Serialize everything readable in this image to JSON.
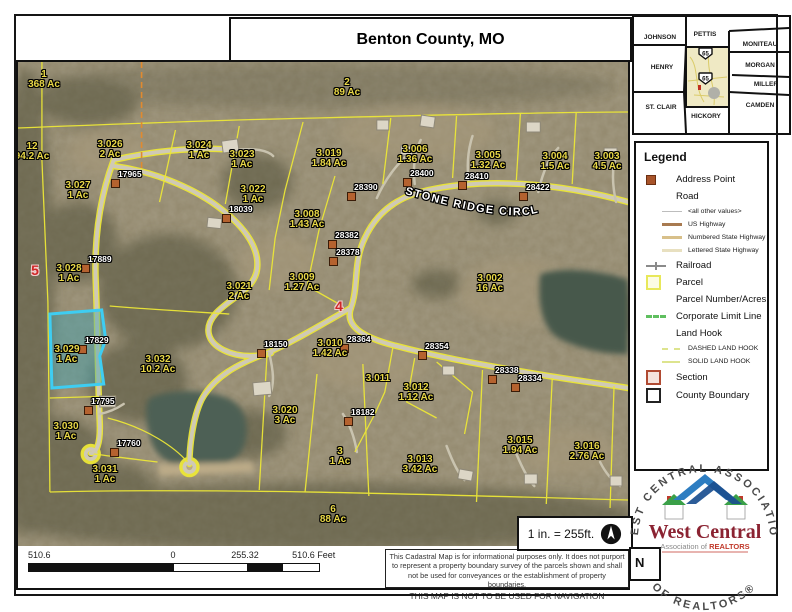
{
  "title": "Benton County, MO",
  "inset_map": {
    "counties": [
      "JOHNSON",
      "PETTIS",
      "MONITEAU",
      "HENRY",
      "MORGAN",
      "MILLER",
      "ST. CLAIR",
      "HICKORY",
      "CAMDEN"
    ],
    "shield_label": "65"
  },
  "legend": {
    "heading": "Legend",
    "items": {
      "address_point": "Address Point",
      "road": "Road",
      "all_other_values": "<all other values>",
      "us_highway": "US Highway",
      "numbered_state_highway": "Numbered State Highway",
      "lettered_state_highway": "Lettered State Highway",
      "railroad": "Railroad",
      "parcel": "Parcel",
      "parcel_number_acres": "Parcel Number/Acres",
      "corporate_limit_line": "Corporate Limit Line",
      "land_hook": "Land Hook",
      "dashed_land_hook": "DASHED LAND HOOK",
      "solid_land_hook": "SOLID LAND HOOK",
      "section": "Section",
      "county_boundary": "County Boundary"
    }
  },
  "map": {
    "street_label": "STONE RIDGE CIRCLE",
    "selected_parcel": "3.029",
    "labels": [
      {
        "text": "1",
        "sub": "368 Ac",
        "x": 26,
        "y": 8
      },
      {
        "text": "2",
        "sub": "89 Ac",
        "x": 329,
        "y": 16
      },
      {
        "text": "12",
        "sub": "94.2 Ac",
        "x": 14,
        "y": 80
      },
      {
        "text": "3.026",
        "sub": "2 Ac",
        "x": 92,
        "y": 78
      },
      {
        "text": "3.024",
        "sub": "1 Ac",
        "x": 181,
        "y": 79
      },
      {
        "text": "3.023",
        "sub": "1 Ac",
        "x": 224,
        "y": 88
      },
      {
        "text": "3.019",
        "sub": "1.84 Ac",
        "x": 311,
        "y": 87
      },
      {
        "text": "3.006",
        "sub": "1.36 Ac",
        "x": 397,
        "y": 83
      },
      {
        "text": "3.005",
        "sub": "1.32 Ac",
        "x": 470,
        "y": 89
      },
      {
        "text": "3.004",
        "sub": "1.5 Ac",
        "x": 537,
        "y": 90
      },
      {
        "text": "3.003",
        "sub": "4.5 Ac",
        "x": 589,
        "y": 90
      },
      {
        "text": "3.027",
        "sub": "1 Ac",
        "x": 60,
        "y": 119
      },
      {
        "text": "3.022",
        "sub": "1 Ac",
        "x": 235,
        "y": 123
      },
      {
        "text": "3.008",
        "sub": "1.43 Ac",
        "x": 289,
        "y": 148
      },
      {
        "text": "3.028",
        "sub": "1 Ac",
        "x": 51,
        "y": 202
      },
      {
        "text": "3.009",
        "sub": "1.27 Ac",
        "x": 284,
        "y": 211
      },
      {
        "text": "3.021",
        "sub": "2 Ac",
        "x": 221,
        "y": 220
      },
      {
        "text": "3.002",
        "sub": "16 Ac",
        "x": 472,
        "y": 212
      },
      {
        "text": "3.029",
        "sub": "1 Ac",
        "x": 49,
        "y": 283
      },
      {
        "text": "3.032",
        "sub": "10.2 Ac",
        "x": 140,
        "y": 293
      },
      {
        "text": "3.010",
        "sub": "1.42 Ac",
        "x": 312,
        "y": 277
      },
      {
        "text": "3.011",
        "sub": "",
        "x": 360,
        "y": 312
      },
      {
        "text": "3.012",
        "sub": "1.12 Ac",
        "x": 398,
        "y": 321
      },
      {
        "text": "3.020",
        "sub": "3 Ac",
        "x": 267,
        "y": 344
      },
      {
        "text": "3.030",
        "sub": "1 Ac",
        "x": 48,
        "y": 360
      },
      {
        "text": "3.031",
        "sub": "1 Ac",
        "x": 87,
        "y": 403
      },
      {
        "text": "3",
        "sub": "1 Ac",
        "x": 322,
        "y": 385
      },
      {
        "text": "3.013",
        "sub": "3.42 Ac",
        "x": 402,
        "y": 393
      },
      {
        "text": "3.015",
        "sub": "1.94 Ac",
        "x": 502,
        "y": 374
      },
      {
        "text": "3.016",
        "sub": "2.76 Ac",
        "x": 569,
        "y": 380
      },
      {
        "text": "6",
        "sub": "88 Ac",
        "x": 315,
        "y": 443
      }
    ],
    "red_section_numbers": [
      {
        "text": "5",
        "x": 17,
        "y": 200
      },
      {
        "text": "4",
        "x": 321,
        "y": 236
      }
    ],
    "address_points": [
      {
        "id": "17965",
        "x": 97,
        "y": 121
      },
      {
        "id": "18039",
        "x": 208,
        "y": 156
      },
      {
        "id": "28390",
        "x": 333,
        "y": 134
      },
      {
        "id": "28400",
        "x": 389,
        "y": 120
      },
      {
        "id": "28410",
        "x": 444,
        "y": 123
      },
      {
        "id": "28422",
        "x": 505,
        "y": 134
      },
      {
        "id": "28382",
        "x": 314,
        "y": 182
      },
      {
        "id": "28378",
        "x": 315,
        "y": 199
      },
      {
        "id": "17889",
        "x": 67,
        "y": 206
      },
      {
        "id": "17829",
        "x": 64,
        "y": 287
      },
      {
        "id": "17795",
        "x": 70,
        "y": 348
      },
      {
        "id": "17760",
        "x": 96,
        "y": 390
      },
      {
        "id": "18150",
        "x": 243,
        "y": 291
      },
      {
        "id": "28364",
        "x": 326,
        "y": 286
      },
      {
        "id": "28354",
        "x": 404,
        "y": 293
      },
      {
        "id": "28338",
        "x": 474,
        "y": 317
      },
      {
        "id": "28334",
        "x": 497,
        "y": 325
      },
      {
        "id": "18182",
        "x": 330,
        "y": 359
      }
    ]
  },
  "scale_bar": {
    "left_label": "510.6",
    "zero_label": "0",
    "mid_label": "255.32",
    "right_label": "510.6 Feet"
  },
  "scale_note": "1 in. = 255ft.",
  "north_box_label": "N",
  "disclaimer": {
    "body": "This Cadastral Map is for informational purposes only.  It does not purport to represent a property boundary survey of the parcels shown and shall not be used for conveyances or the establishment of property boundaries.",
    "warning": "THIS MAP IS NOT TO BE USED FOR NAVIGATION"
  },
  "logo": {
    "ring_text_top": "WEST CENTRAL ASSOCIATION",
    "ring_text_bottom": "OF REALTORS®",
    "name": "West Central",
    "subtitle_prefix": "Association of ",
    "subtitle_realtors": "REALTORS"
  }
}
